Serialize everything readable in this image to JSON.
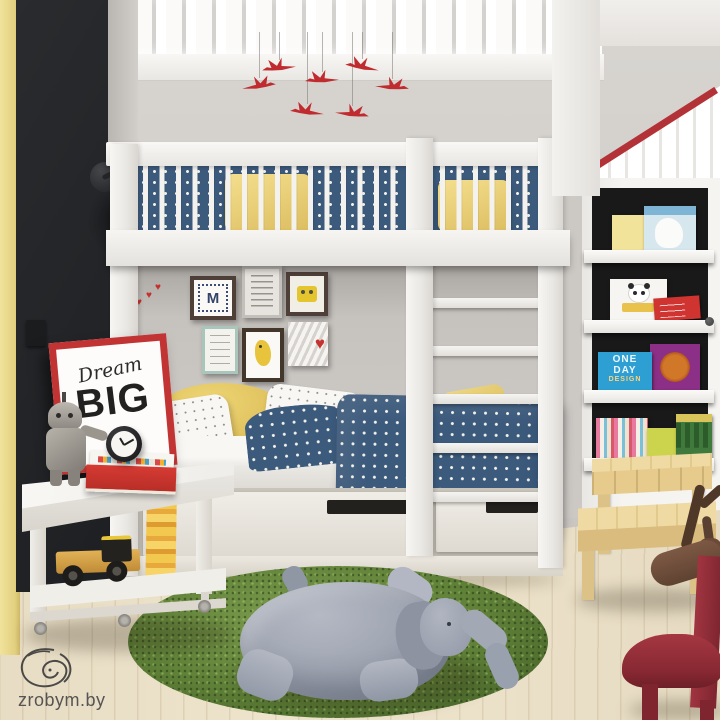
{
  "scene": {
    "description": "3D interior render: kids bedroom with white bunk bed, black accent wall, red origami crane mobile, gallery wall, bookshelf wardrobe, grass rug with plush elephant",
    "watermark": {
      "text": "zrobym.by"
    },
    "poster": {
      "word_script": "Dream",
      "word_big": "BIG"
    },
    "gallery_wall": {
      "monogram": "M"
    },
    "bookshelf": {
      "book_one_day_design": {
        "line1": "ONE",
        "line2": "DAY",
        "line3": "DESIGN"
      }
    },
    "icons": {
      "heart": "♥"
    },
    "colors": {
      "accent_yellow": "#e9da8e",
      "black_wall": "#26282a",
      "bed_white": "#f2f1ee",
      "bedding_blue": "#3c5a7c",
      "pillow_yellow": "#eed67e",
      "crane_red": "#bf2b2e",
      "rug_green": "#5e7f37",
      "elephant_grey": "#a2a8b4",
      "chair_red": "#8e2a32",
      "roof_trim_red": "#b23237",
      "wood_floor": "#e9dfc9",
      "stool_wood": "#e2c88c"
    }
  }
}
